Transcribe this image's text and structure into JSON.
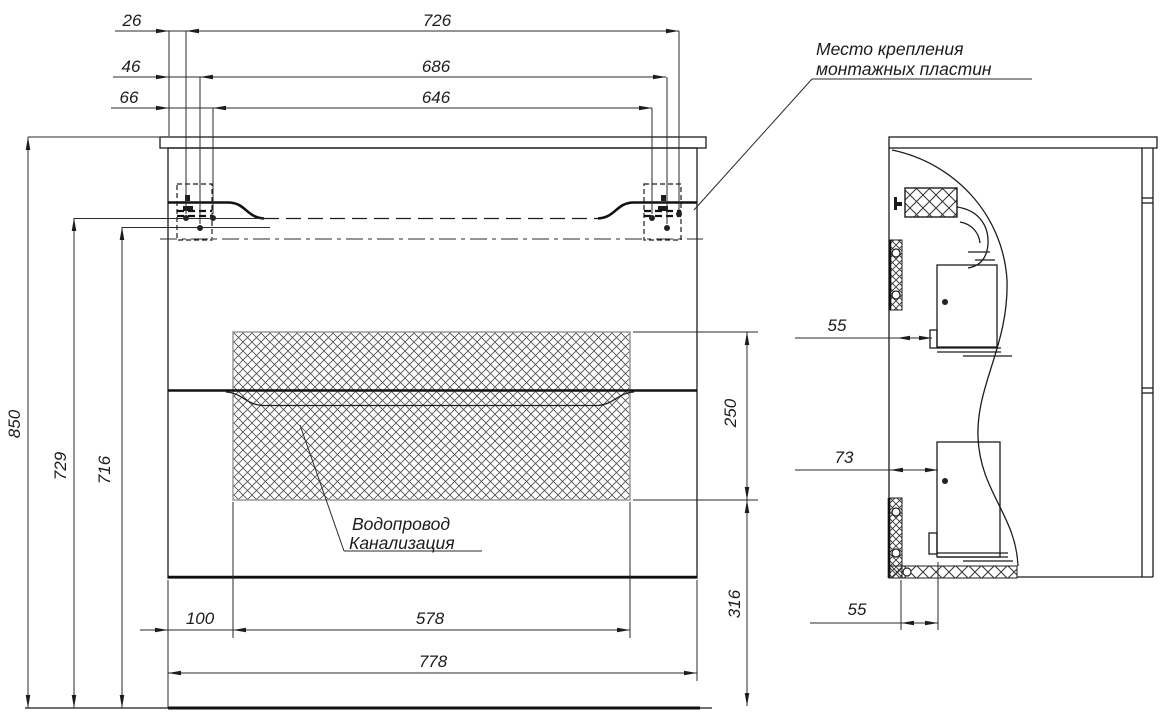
{
  "front_view": {
    "dims_top": {
      "offset1": "26",
      "offset2": "46",
      "offset3": "66",
      "span1": "726",
      "span2": "686",
      "span3": "646"
    },
    "dims_left": {
      "total_height": "850",
      "to_drawer_top": "729",
      "to_mount_axis": "716"
    },
    "dims_right": {
      "hatch_height": "250",
      "bottom_clearance": "316"
    },
    "dims_bottom": {
      "side_inset": "100",
      "opening_width": "578",
      "cabinet_width": "778"
    },
    "labels": {
      "mounting_line1": "Место крепления",
      "mounting_line2": "монтажных пластин",
      "plumbing_line1": "Водопровод",
      "plumbing_line2": "Канализация"
    }
  },
  "side_view": {
    "dims": {
      "top_offset": "55",
      "mid_offset": "73",
      "bottom_offset": "55"
    }
  },
  "colors": {
    "line": "#1c1c1c",
    "hatch_line": "#4d4d4d",
    "hatch_border": "#9a9a9a",
    "background": "#ffffff"
  }
}
